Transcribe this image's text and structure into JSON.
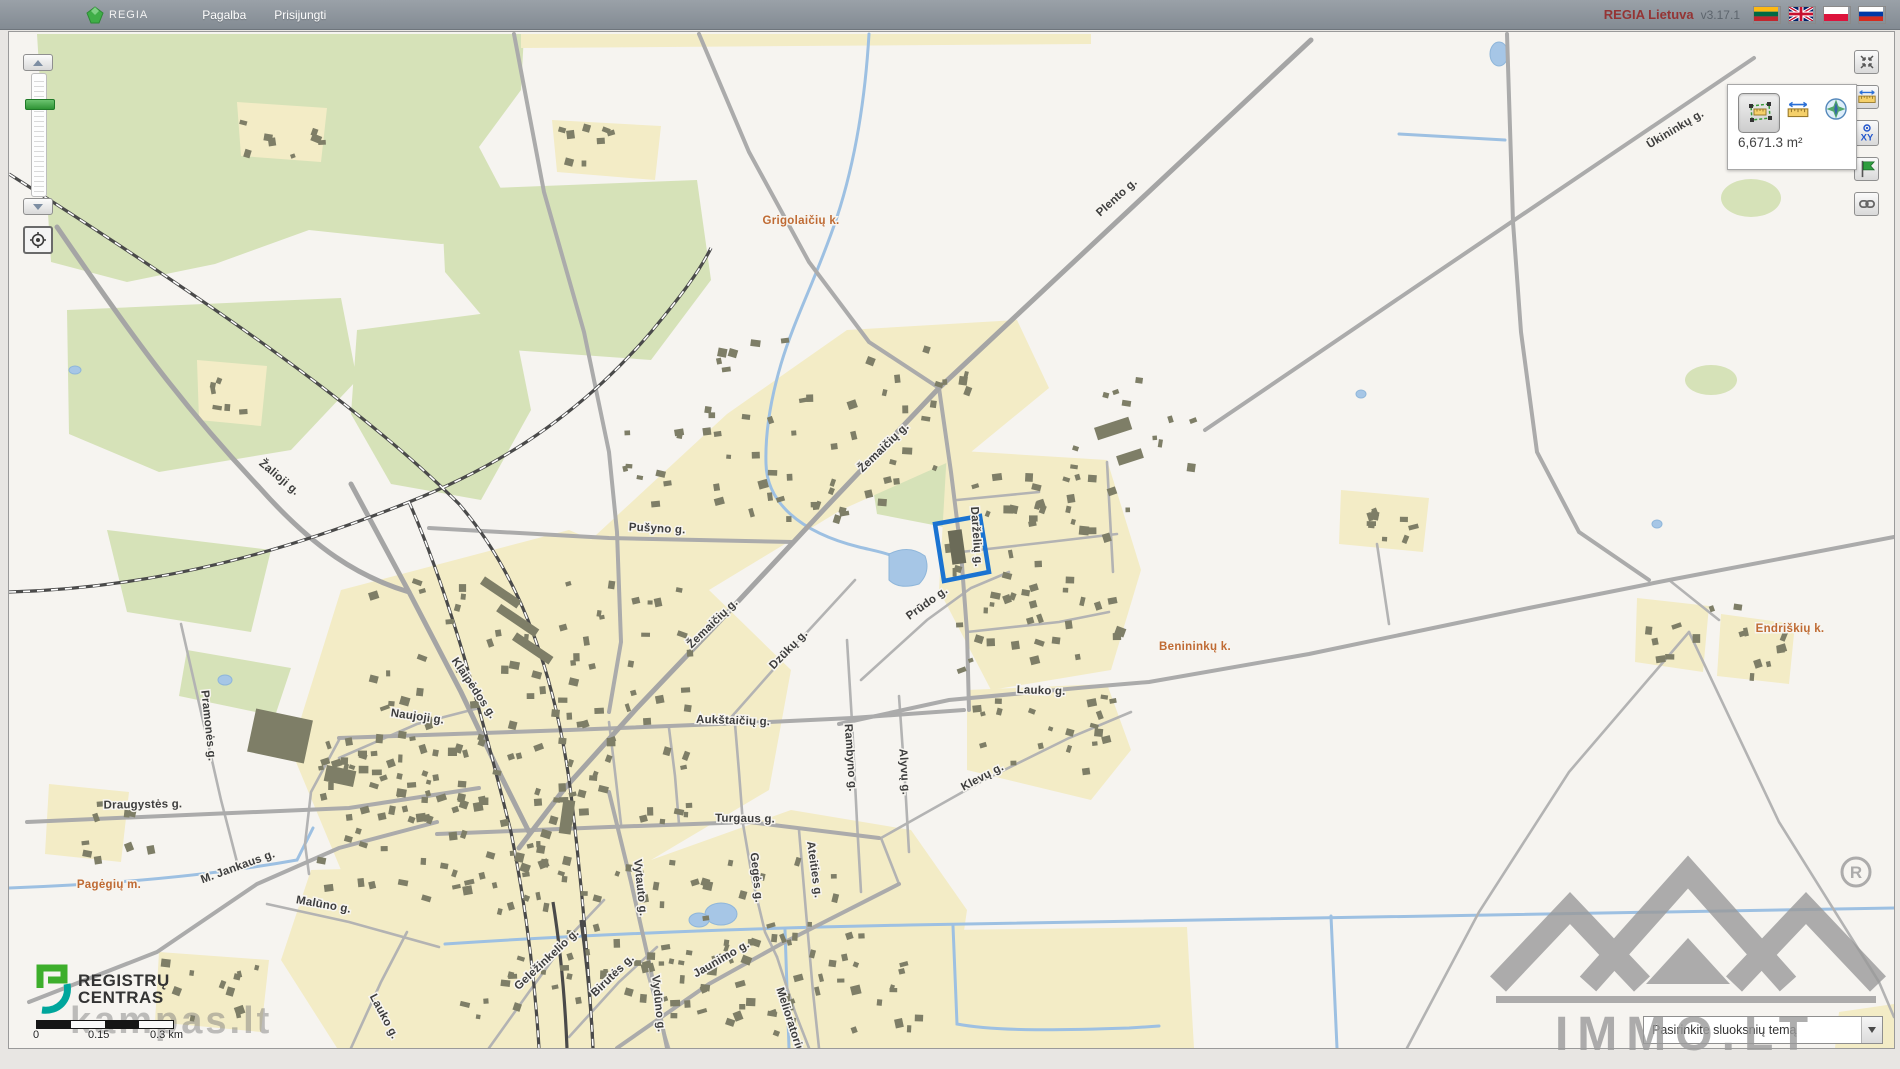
{
  "topbar": {
    "brand": "REGIA",
    "menu": [
      {
        "label": "Pagalba"
      },
      {
        "label": "Prisijungti"
      }
    ],
    "version_brand": "REGIA Lietuva",
    "version": "v3.17.1",
    "flags": [
      "Lietuvių",
      "English",
      "Polski",
      "Русский"
    ]
  },
  "controls": {
    "measure_panel": {
      "area_value": "6,671.3 m²"
    },
    "scalebar": {
      "start": "0",
      "mid": "0.15",
      "end": "0.3 km"
    },
    "layers_dropdown": {
      "placeholder": "Pasirinkite sluoksnių temą"
    }
  },
  "branding": {
    "registry_line1": "REGISTRŲ",
    "registry_line2": "CENTRAS",
    "watermark_left": "kampas.lt",
    "watermark_right": "IMMO.LT"
  },
  "map": {
    "colors": {
      "forest": "#d6e2b8",
      "residential": "#f3ecc6",
      "water": "#a6c6e6",
      "building": "#7e7e67",
      "road": "#ababab",
      "rail": "#4a4a4a",
      "highlight": "#1a73d1"
    },
    "street_labels": [
      {
        "text": "Plento g.",
        "x": 1110,
        "y": 168,
        "rot": -42
      },
      {
        "text": "Ūkininkų g.",
        "x": 1668,
        "y": 100,
        "rot": -31
      },
      {
        "text": "Žalioji g.",
        "x": 268,
        "y": 448,
        "rot": 40
      },
      {
        "text": "Pušyno g.",
        "x": 648,
        "y": 500,
        "rot": 3
      },
      {
        "text": "Žemaičių g.",
        "x": 877,
        "y": 418,
        "rot": -44
      },
      {
        "text": "Žemaičių g.",
        "x": 706,
        "y": 594,
        "rot": -44
      },
      {
        "text": "Dzūkų g.",
        "x": 782,
        "y": 620,
        "rot": -46
      },
      {
        "text": "Darželių g.",
        "x": 964,
        "y": 505,
        "rot": 86
      },
      {
        "text": "Prūdo g.",
        "x": 920,
        "y": 574,
        "rot": -36
      },
      {
        "text": "Aukštaičių g.",
        "x": 724,
        "y": 692,
        "rot": 2
      },
      {
        "text": "Rambyno g.",
        "x": 838,
        "y": 726,
        "rot": 86
      },
      {
        "text": "Alyvų g.",
        "x": 892,
        "y": 740,
        "rot": 86
      },
      {
        "text": "Klevų g.",
        "x": 975,
        "y": 748,
        "rot": -28
      },
      {
        "text": "Lauko g.",
        "x": 1032,
        "y": 662,
        "rot": 2
      },
      {
        "text": "Turgaus g.",
        "x": 736,
        "y": 790,
        "rot": 1
      },
      {
        "text": "Ateities g.",
        "x": 802,
        "y": 838,
        "rot": 82
      },
      {
        "text": "Gegės g.",
        "x": 744,
        "y": 846,
        "rot": 84
      },
      {
        "text": "Jaunimo g.",
        "x": 714,
        "y": 930,
        "rot": -30
      },
      {
        "text": "Melioratorių g.",
        "x": 780,
        "y": 996,
        "rot": 72
      },
      {
        "text": "Vytauto g.",
        "x": 628,
        "y": 856,
        "rot": 84
      },
      {
        "text": "Birutės g.",
        "x": 606,
        "y": 946,
        "rot": -44
      },
      {
        "text": "Vydūno g.",
        "x": 646,
        "y": 972,
        "rot": 84
      },
      {
        "text": "Geležinkelio g.",
        "x": 540,
        "y": 930,
        "rot": -43
      },
      {
        "text": "Klaipėdos g.",
        "x": 462,
        "y": 658,
        "rot": 56
      },
      {
        "text": "Naujoji g.",
        "x": 408,
        "y": 688,
        "rot": 8
      },
      {
        "text": "Pramonės g.",
        "x": 196,
        "y": 694,
        "rot": 84
      },
      {
        "text": "Draugystės g.",
        "x": 134,
        "y": 776,
        "rot": -1
      },
      {
        "text": "M. Jankaus g.",
        "x": 230,
        "y": 838,
        "rot": -20
      },
      {
        "text": "Malūno g.",
        "x": 314,
        "y": 876,
        "rot": 10
      },
      {
        "text": "Lauko g.",
        "x": 372,
        "y": 986,
        "rot": 62
      }
    ],
    "place_labels": [
      {
        "text": "Grigolaičių k.",
        "x": 792,
        "y": 192
      },
      {
        "text": "Benininkų k.",
        "x": 1186,
        "y": 618
      },
      {
        "text": "Endriškių k.",
        "x": 1781,
        "y": 600
      },
      {
        "text": "Pagėgių m.",
        "x": 100,
        "y": 856
      }
    ],
    "building_zones": [
      [
        600,
        362,
        330,
        130,
        50
      ],
      [
        932,
        432,
        190,
        210,
        58
      ],
      [
        360,
        545,
        330,
        250,
        105
      ],
      [
        300,
        702,
        280,
        168,
        65
      ],
      [
        432,
        820,
        400,
        168,
        80
      ],
      [
        622,
        900,
        300,
        105,
        40
      ],
      [
        955,
        662,
        155,
        82,
        20
      ],
      [
        850,
        300,
        125,
        78,
        10
      ],
      [
        1050,
        342,
        140,
        108,
        10
      ],
      [
        228,
        74,
        92,
        54,
        8
      ],
      [
        546,
        92,
        106,
        52,
        8
      ],
      [
        190,
        330,
        66,
        58,
        6
      ],
      [
        1630,
        568,
        152,
        82,
        13
      ],
      [
        1336,
        462,
        86,
        56,
        9
      ],
      [
        48,
        754,
        108,
        84,
        9
      ],
      [
        152,
        922,
        148,
        76,
        11
      ],
      [
        700,
        300,
        90,
        60,
        6
      ],
      [
        1712,
        590,
        70,
        50,
        6
      ]
    ]
  }
}
